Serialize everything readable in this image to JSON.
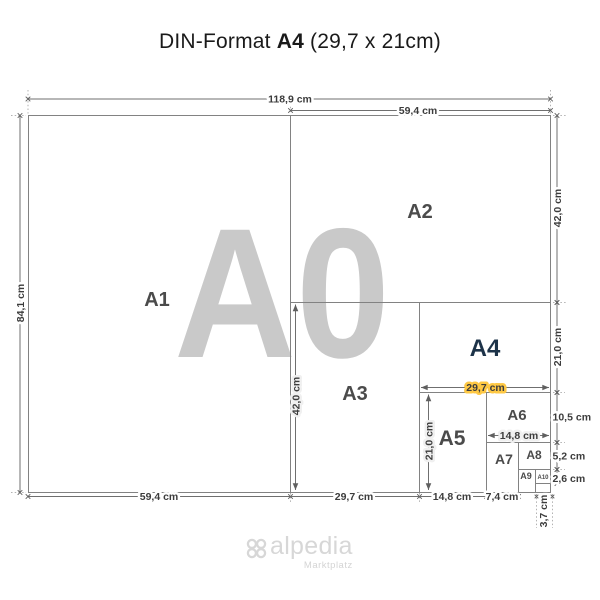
{
  "title": {
    "prefix": "DIN-Format ",
    "format": "A4",
    "suffix": " (29,7 x 21cm)"
  },
  "watermark": {
    "label": "A0"
  },
  "regions": {
    "a1": "A1",
    "a2": "A2",
    "a3": "A3",
    "a4": "A4",
    "a5": "A5",
    "a6": "A6",
    "a7": "A7",
    "a8": "A8",
    "a9": "A9",
    "a10": "A10"
  },
  "dims": {
    "a0_width": "118,9 cm",
    "a2_width": "59,4 cm",
    "a0_height": "84,1 cm",
    "a2_height": "42,0 cm",
    "a4_height": "21,0 cm",
    "a6_height": "10,5 cm",
    "a8_height": "5,2 cm",
    "a10_height": "2,6 cm",
    "a1_width": "59,4 cm",
    "a3_width": "29,7 cm",
    "a5_width": "14,8 cm",
    "a7_width": "7,4 cm",
    "a9_width": "3,7 cm",
    "a4_inner_width": "29,7 cm",
    "a6_inner_width": "14,8 cm",
    "a3_inner_height": "42,0 cm",
    "a5_inner_height": "21,0 cm"
  },
  "logo": {
    "brand": "alpedia",
    "tagline": "Marktplatz"
  },
  "colors": {
    "highlight": "#FEC844",
    "paper": "#F0F0F0",
    "watermark": "#C9C9C9",
    "outline": "#828282",
    "accent_text": "#1D3349"
  }
}
